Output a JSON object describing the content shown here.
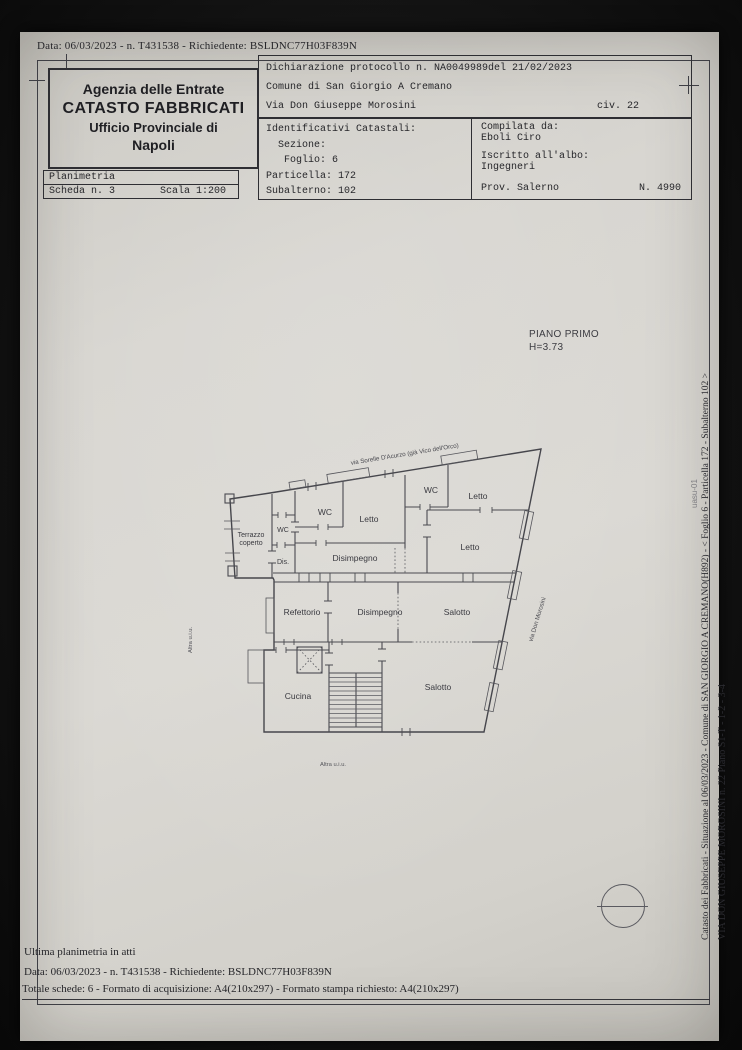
{
  "colors": {
    "paper": "#d8d6d1",
    "ink": "#26262a",
    "line": "#4a4a50",
    "photo_bg": "#141414"
  },
  "photo": {
    "top_line": "Data: 06/03/2023 - n. T431538 - Richiedente: BSLDNC77H03F839N"
  },
  "header": {
    "agency": {
      "line1": "Agenzia delle Entrate",
      "line2": "CATASTO FABBRICATI",
      "line3": "Ufficio Provinciale di",
      "line4": "Napoli"
    },
    "planimetria": {
      "title": "Planimetria",
      "scheda": "Scheda n. 3",
      "scala": "Scala 1:200"
    },
    "declaration": {
      "line1": "Dichiarazione protocollo n. NA0049989del  21/02/2023",
      "line2": "Comune di San Giorgio A Cremano",
      "line3": "Via Don Giuseppe Morosini",
      "civ": "civ. 22"
    },
    "catastali": {
      "title": "Identificativi Catastali:",
      "sezione": "  Sezione:",
      "foglio": "   Foglio: 6",
      "particella": "Particella: 172",
      "subalterno": "Subalterno: 102"
    },
    "compiler": {
      "label": "Compilata da:",
      "name": "Eboli Ciro",
      "albo_label": "Iscritto all'albo:",
      "albo": "Ingegneri",
      "prov": "Prov. Salerno",
      "num": "N. 4990"
    }
  },
  "plan": {
    "floor_title": "PIANO PRIMO",
    "floor_height": "H=3.73",
    "labels": {
      "terrazzo1": "Terrazzo",
      "terrazzo2": "coperto",
      "wc": "WC",
      "dis": "Dis.",
      "letto": "Letto",
      "disimpegno": "Disimpegno",
      "refettorio": "Refettorio",
      "salotto": "Salotto",
      "cucina": "Cucina"
    },
    "streets": {
      "top": "via Sorelle D'Acurzo (già Vico dell'Orco)",
      "right": "via Don Morosini"
    },
    "notes": {
      "altra_left": "Altra u.i.u.",
      "altra_bottom": "Altra u.i.u."
    }
  },
  "margin": {
    "line1": "Catasto dei Fabbricati - Situazione al 06/03/2023 - Comune di SAN GIORGIO A CREMANO(H892) - < Foglio 6 - Particella 172 - Subalterno 102 >",
    "line2": "VIA DON GIUSEPPE MOROSINI n. 22 Piano S1-T - 1-2 - 3-4",
    "mark": "uasu-01"
  },
  "footer": {
    "line1": "Ultima planimetria in atti",
    "line2": "Data: 06/03/2023 - n. T431538 - Richiedente: BSLDNC77H03F839N",
    "line3": "Totale schede: 6 - Formato di acquisizione: A4(210x297)  - Formato stampa richiesto: A4(210x297)"
  }
}
